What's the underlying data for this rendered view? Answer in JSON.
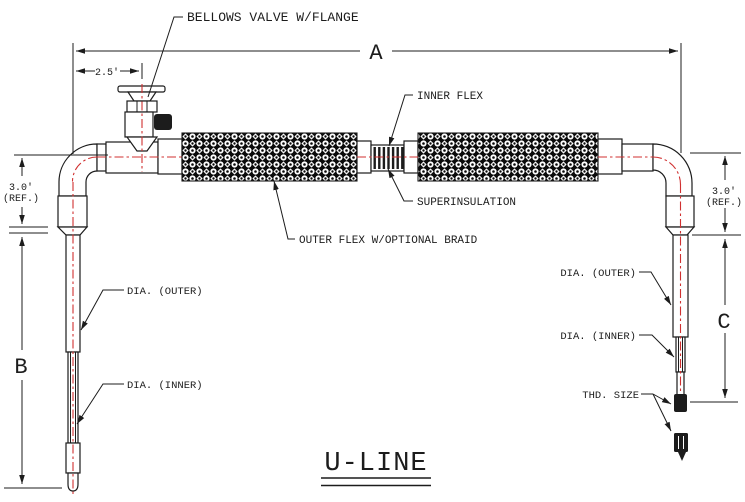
{
  "drawing": {
    "title": "U-LINE",
    "callouts": {
      "bellows_valve": "BELLOWS VALVE W/FLANGE",
      "inner_flex": "INNER FLEX",
      "superinsulation": "SUPERINSULATION",
      "outer_flex": "OUTER FLEX W/OPTIONAL BRAID",
      "dia_outer_left": "DIA. (OUTER)",
      "dia_inner_left": "DIA. (INNER)",
      "dia_outer_right": "DIA. (OUTER)",
      "dia_inner_right": "DIA. (INNER)",
      "thd_size": "THD. SIZE"
    },
    "dimensions": {
      "overall_length": "A",
      "left_leg_length": "B",
      "right_leg_length": "C",
      "valve_offset": "2.5'",
      "left_ref_value": "3.0'",
      "left_ref_note": "(REF.)",
      "right_ref_value": "3.0'",
      "right_ref_note": "(REF.)"
    },
    "colors": {
      "line": "#1c1c1c",
      "centerline": "#d03030",
      "braid_fill": "#0b0b0b"
    }
  }
}
